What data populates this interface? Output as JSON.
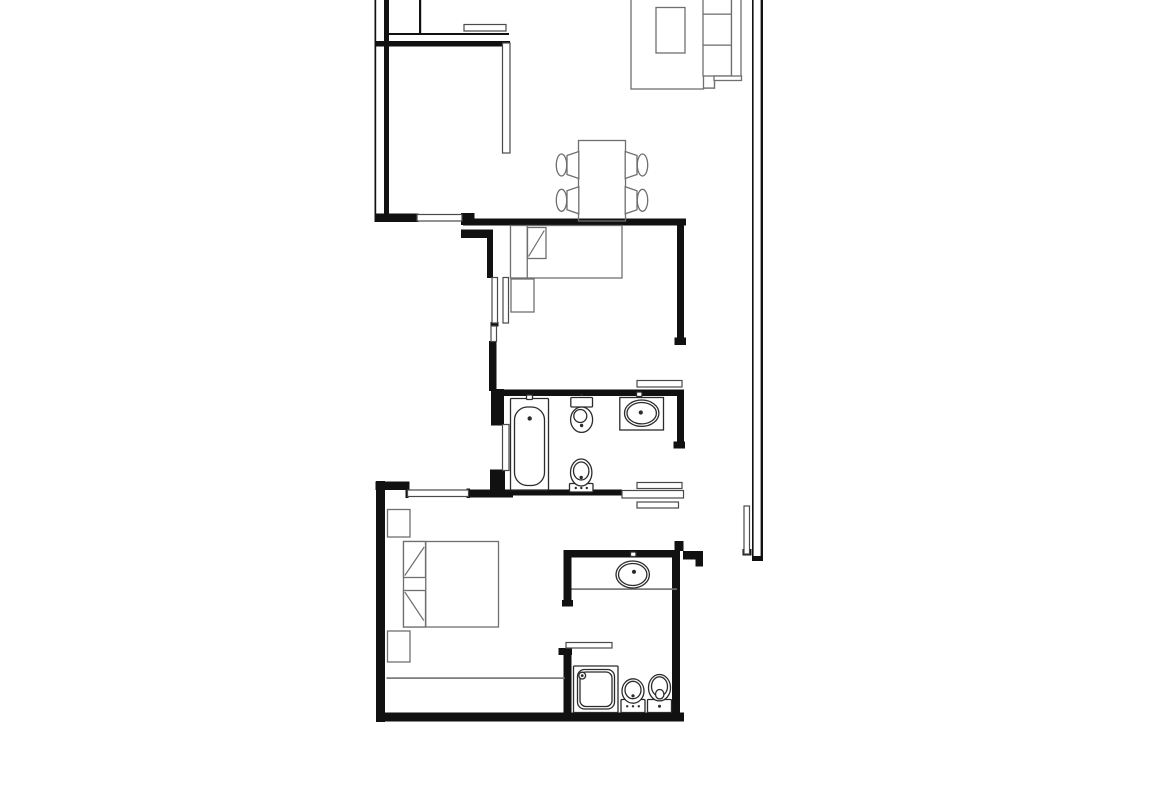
{
  "meta": {
    "title": "apartment-floor-plan",
    "canvas_w": 1170,
    "canvas_h": 785,
    "background": "#ffffff"
  },
  "colors": {
    "wall": "#111111",
    "window": "#4a4a4a",
    "sanitary": "#2b2b2b",
    "furniture": "#6f6f6f",
    "light": "#9a9a9a"
  },
  "walls": [
    {
      "id": "left-wall-outer-line",
      "x": 374.5,
      "y": 0,
      "w": 1.7,
      "h": 221
    },
    {
      "id": "left-wall-inner",
      "x": 384,
      "y": 0,
      "w": 5,
      "h": 216
    },
    {
      "id": "kitchen-wall-thin-line",
      "x": 385,
      "y": 33,
      "w": 124,
      "h": 2
    },
    {
      "id": "kitchen-south-wall",
      "x": 374.5,
      "y": 41,
      "w": 135.5,
      "h": 5.5
    },
    {
      "id": "kitchen-divider-line",
      "x": 419,
      "y": 0,
      "w": 2.2,
      "h": 34
    },
    {
      "id": "living-south-wall",
      "x": 374.5,
      "y": 213.5,
      "w": 44,
      "h": 8.5
    },
    {
      "id": "living-south-jog",
      "x": 461,
      "y": 213,
      "w": 13.5,
      "h": 12
    },
    {
      "id": "bedroom1-north-wall",
      "x": 463,
      "y": 218.5,
      "w": 223,
      "h": 7
    },
    {
      "id": "bedroom1-east-wall",
      "x": 677,
      "y": 219,
      "w": 7,
      "h": 119
    },
    {
      "id": "bedroom1-east-wall-cap",
      "x": 674.5,
      "y": 337.5,
      "w": 11.5,
      "h": 7.5
    },
    {
      "id": "lightwell-stub",
      "x": 461,
      "y": 229.5,
      "w": 32,
      "h": 8.5
    },
    {
      "id": "lightwell-wall-upper",
      "x": 487,
      "y": 238,
      "w": 6,
      "h": 40
    },
    {
      "id": "lightwell-window-connector",
      "x": 490.5,
      "y": 322,
      "w": 8,
      "h": 4.5
    },
    {
      "id": "lightwell-wall-lower",
      "x": 489,
      "y": 341,
      "w": 7.5,
      "h": 50
    },
    {
      "id": "bath1-nw-chunk",
      "x": 491,
      "y": 389,
      "w": 13,
      "h": 36.5
    },
    {
      "id": "bath1-north-wall",
      "x": 491,
      "y": 389.5,
      "w": 193,
      "h": 6.5
    },
    {
      "id": "bath1-east-wall",
      "x": 677,
      "y": 390,
      "w": 7,
      "h": 53
    },
    {
      "id": "bath1-east-wall-cap",
      "x": 673.5,
      "y": 441.5,
      "w": 11.5,
      "h": 7
    },
    {
      "id": "bath1-sw-chunk",
      "x": 490,
      "y": 469.5,
      "w": 15,
      "h": 21
    },
    {
      "id": "bath1-south-wall",
      "x": 508,
      "y": 489.5,
      "w": 114,
      "h": 6
    },
    {
      "id": "bedroom2-west-wall",
      "x": 376,
      "y": 481,
      "w": 9,
      "h": 241
    },
    {
      "id": "bedroom2-north-wall-a",
      "x": 375.5,
      "y": 481.5,
      "w": 34,
      "h": 8.5
    },
    {
      "id": "bedroom2-north-wall-b",
      "x": 467.5,
      "y": 489.5,
      "w": 45.5,
      "h": 8
    },
    {
      "id": "window-bedroom2-cap-left",
      "x": 405.5,
      "y": 488.5,
      "w": 3,
      "h": 9.5
    },
    {
      "id": "window-bedroom2-cap-right",
      "x": 466.5,
      "y": 488.5,
      "w": 3.5,
      "h": 9.5
    },
    {
      "id": "south-wall",
      "x": 376,
      "y": 712.5,
      "w": 308,
      "h": 9
    },
    {
      "id": "bath2-west-wall-upper",
      "x": 563.5,
      "y": 550,
      "w": 8,
      "h": 53
    },
    {
      "id": "bath2-west-cap-1",
      "x": 562,
      "y": 600,
      "w": 11,
      "h": 6.5
    },
    {
      "id": "bath2-west-cap-2",
      "x": 558.5,
      "y": 648,
      "w": 13.5,
      "h": 7
    },
    {
      "id": "bath2-west-wall-lower",
      "x": 563.5,
      "y": 650,
      "w": 8,
      "h": 71
    },
    {
      "id": "bath2-north-wall",
      "x": 563.5,
      "y": 550,
      "w": 112.5,
      "h": 7.5
    },
    {
      "id": "bath2-north-tab",
      "x": 674.5,
      "y": 541,
      "w": 9,
      "h": 10
    },
    {
      "id": "entry-wall",
      "x": 683,
      "y": 551,
      "w": 19.5,
      "h": 8.5
    },
    {
      "id": "entry-wall-cap",
      "x": 695.5,
      "y": 551,
      "w": 7.5,
      "h": 15.5
    },
    {
      "id": "bath2-east-wall",
      "x": 672,
      "y": 550,
      "w": 8,
      "h": 171
    },
    {
      "id": "right-wall-inner-line",
      "x": 752,
      "y": 0,
      "w": 1.6,
      "h": 557
    },
    {
      "id": "right-wall-outer-line",
      "x": 760.6,
      "y": 0,
      "w": 2.4,
      "h": 561
    },
    {
      "id": "right-wall-cap",
      "x": 752,
      "y": 556,
      "w": 11,
      "h": 5
    },
    {
      "id": "entry-leaf-cap",
      "x": 742.5,
      "y": 549,
      "w": 9,
      "h": 6.5
    }
  ],
  "openings": [
    {
      "id": "window-living",
      "x": 417,
      "y": 214.5,
      "w": 45,
      "h": 6.5
    },
    {
      "id": "window-lightwell-a",
      "x": 492,
      "y": 277.5,
      "w": 5.5,
      "h": 45.5
    },
    {
      "id": "window-lightwell-b",
      "x": 503,
      "y": 277.5,
      "w": 5.5,
      "h": 45.5
    },
    {
      "id": "window-lightwell-c",
      "x": 491,
      "y": 326,
      "w": 5.5,
      "h": 15.5
    },
    {
      "id": "window-bath1",
      "x": 502.5,
      "y": 424.5,
      "w": 6.5,
      "h": 46
    },
    {
      "id": "window-bedroom2",
      "x": 407.5,
      "y": 490,
      "w": 61,
      "h": 6.5
    },
    {
      "id": "door-leaf-bath1-top",
      "x": 637,
      "y": 380.5,
      "w": 45,
      "h": 6.5
    },
    {
      "id": "door-leaf-corridor-a",
      "x": 637,
      "y": 482.5,
      "w": 45,
      "h": 6
    },
    {
      "id": "passage-wall-bar",
      "x": 622,
      "y": 490.5,
      "w": 61.5,
      "h": 7.5
    },
    {
      "id": "door-leaf-corridor-b",
      "x": 637,
      "y": 502,
      "w": 41.5,
      "h": 6
    },
    {
      "id": "entry-door-leaf",
      "x": 744,
      "y": 506,
      "w": 5.5,
      "h": 48
    },
    {
      "id": "door-leaf-bath2",
      "x": 566,
      "y": 642.5,
      "w": 46,
      "h": 5.5
    },
    {
      "id": "kitchen-counter",
      "x": 464,
      "y": 24.5,
      "w": 42,
      "h": 6.5
    },
    {
      "id": "kitchen-partition",
      "x": 502.5,
      "y": 43,
      "w": 7.5,
      "h": 110
    }
  ],
  "furniture_rects": [
    {
      "id": "sofa-body",
      "x": 631,
      "y": -5,
      "w": 72.5,
      "h": 94
    },
    {
      "id": "sofa-coffee-table",
      "x": 656,
      "y": 7.5,
      "w": 29,
      "h": 45.5
    },
    {
      "id": "sofa-seat-column",
      "x": 703,
      "y": -5,
      "w": 28.5,
      "h": 81
    },
    {
      "id": "sofa-backrest",
      "x": 731.5,
      "y": -5,
      "w": 9.5,
      "h": 85
    },
    {
      "id": "sofa-armrest",
      "x": 714,
      "y": 76,
      "w": 27.5,
      "h": 4.5
    },
    {
      "id": "dining-table",
      "x": 578.5,
      "y": 140.5,
      "w": 47,
      "h": 80.5,
      "fill": "none"
    },
    {
      "id": "bed-single",
      "x": 510.5,
      "y": 225.5,
      "w": 111.5,
      "h": 52.5
    },
    {
      "id": "bed-single-pillow",
      "x": 527.5,
      "y": 227.5,
      "w": 18.5,
      "h": 31
    },
    {
      "id": "nightstand-bedroom1",
      "x": 511,
      "y": 279,
      "w": 23,
      "h": 33
    },
    {
      "id": "bed-double",
      "x": 403.5,
      "y": 541.5,
      "w": 95,
      "h": 85.5
    },
    {
      "id": "bed-double-pillow-top",
      "x": 403.5,
      "y": 541.5,
      "w": 22,
      "h": 36
    },
    {
      "id": "bed-double-pillow-bottom",
      "x": 403.5,
      "y": 590.5,
      "w": 22,
      "h": 36.5
    },
    {
      "id": "nightstand-bedroom2-top",
      "x": 387.5,
      "y": 509.5,
      "w": 22.5,
      "h": 27.5
    },
    {
      "id": "nightstand-bedroom2-bottom",
      "x": 387.5,
      "y": 631,
      "w": 22.5,
      "h": 31
    }
  ],
  "furniture_lines": [
    {
      "id": "sofa-cushion-divider-1",
      "x": 703,
      "y": 13.5,
      "w": 28.5,
      "h": 1.3
    },
    {
      "id": "sofa-cushion-divider-2",
      "x": 703,
      "y": 44.5,
      "w": 28.5,
      "h": 1.3
    },
    {
      "id": "sofa-step-h",
      "x": 703,
      "y": 87.4,
      "w": 11.8,
      "h": 1.4
    },
    {
      "id": "sofa-step-v",
      "x": 713.8,
      "y": 80,
      "w": 1.4,
      "h": 8.8
    },
    {
      "id": "bed-single-headboard-line",
      "x": 526.6,
      "y": 225.5,
      "w": 1.3,
      "h": 52.5
    },
    {
      "id": "bed-double-headboard-line",
      "x": 425.1,
      "y": 541.5,
      "w": 1.3,
      "h": 85.5
    },
    {
      "id": "wardrobe-line",
      "x": 386.5,
      "y": 677.3,
      "w": 178.5,
      "h": 1.6
    },
    {
      "id": "vanity2-front-edge",
      "x": 571.5,
      "y": 588.3,
      "w": 105.5,
      "h": 1.6
    }
  ],
  "sanitary_rects": [
    {
      "id": "bathtub-outer",
      "x": 510.5,
      "y": 398.5,
      "w": 38,
      "h": 91.5,
      "r": 1
    },
    {
      "id": "bathtub-inner",
      "x": 514.5,
      "y": 407,
      "w": 30,
      "h": 78.5,
      "r": 13
    },
    {
      "id": "bathtub-tap",
      "x": 526.5,
      "y": 395,
      "w": 6,
      "h": 4.5,
      "r": 1
    },
    {
      "id": "toilet1-cistern",
      "x": 570.8,
      "y": 397.5,
      "w": 21.7,
      "h": 9.5,
      "r": 1
    },
    {
      "id": "vanity1-counter",
      "x": 619.8,
      "y": 397.5,
      "w": 43.7,
      "h": 32.5,
      "r": 0
    },
    {
      "id": "sink1-tap",
      "x": 636.5,
      "y": 392,
      "w": 5.5,
      "h": 4.5,
      "r": 1
    },
    {
      "id": "bidet1-base",
      "x": 569.5,
      "y": 483.5,
      "w": 23.5,
      "h": 8.5,
      "r": 1
    },
    {
      "id": "sink2-tap",
      "x": 630.5,
      "y": 552,
      "w": 5.5,
      "h": 4.5,
      "r": 1
    },
    {
      "id": "shower-tray-outer",
      "x": 573.5,
      "y": 666,
      "w": 44.5,
      "h": 46.5,
      "r": 1
    },
    {
      "id": "shower-tray-mid",
      "x": 577.5,
      "y": 669.5,
      "w": 37,
      "h": 39.5,
      "r": 7
    },
    {
      "id": "shower-tray-inner",
      "x": 580,
      "y": 672,
      "w": 32,
      "h": 34.5,
      "r": 6
    },
    {
      "id": "toilet2-base",
      "x": 621,
      "y": 699.5,
      "w": 24,
      "h": 13,
      "r": 1
    },
    {
      "id": "bidet2-base",
      "x": 647.5,
      "y": 699.5,
      "w": 24,
      "h": 13,
      "r": 1
    }
  ],
  "sanitary_ellipses": [
    {
      "id": "toilet1-bowl",
      "cx": 581.6,
      "cy": 419.7,
      "rx": 11,
      "ry": 12.7
    },
    {
      "id": "toilet1-flush",
      "cx": 580.3,
      "cy": 416,
      "rx": 6.5,
      "ry": 6.5
    },
    {
      "id": "sink1-basin-outer",
      "cx": 641.7,
      "cy": 413.2,
      "rx": 17.2,
      "ry": 13.2
    },
    {
      "id": "sink1-basin-inner",
      "cx": 641.7,
      "cy": 413.2,
      "rx": 14.7,
      "ry": 10.7
    },
    {
      "id": "bidet1-bowl",
      "cx": 581.2,
      "cy": 472.5,
      "rx": 10.7,
      "ry": 13.5
    },
    {
      "id": "bidet1-inner",
      "cx": 581.2,
      "cy": 471,
      "rx": 7.7,
      "ry": 9
    },
    {
      "id": "sink2-basin-outer",
      "cx": 632.7,
      "cy": 574.5,
      "rx": 16.7,
      "ry": 13.5
    },
    {
      "id": "sink2-basin-inner",
      "cx": 632.7,
      "cy": 574.5,
      "rx": 14.2,
      "ry": 11
    },
    {
      "id": "shower-head-ring",
      "cx": 582.2,
      "cy": 675.6,
      "rx": 3.4,
      "ry": 3.4
    },
    {
      "id": "toilet2-bowl",
      "cx": 633,
      "cy": 691,
      "rx": 11,
      "ry": 12.2
    },
    {
      "id": "toilet2-inner",
      "cx": 633,
      "cy": 690,
      "rx": 8,
      "ry": 8.7
    },
    {
      "id": "bidet2-bowl",
      "cx": 659.5,
      "cy": 687.7,
      "rx": 11,
      "ry": 13.2
    },
    {
      "id": "bidet2-inner",
      "cx": 659.5,
      "cy": 686.5,
      "rx": 8,
      "ry": 9.7
    },
    {
      "id": "bidet2-drain",
      "cx": 659.7,
      "cy": 694.2,
      "rx": 4.2,
      "ry": 4.7
    },
    {
      "id": "chair-back-top-left",
      "cx": 561.5,
      "cy": 165,
      "rx": 5.2,
      "ry": 11,
      "stroke": "furniture"
    },
    {
      "id": "chair-back-bottom-left",
      "cx": 561.5,
      "cy": 200.3,
      "rx": 5.2,
      "ry": 11,
      "stroke": "furniture"
    },
    {
      "id": "chair-back-top-right",
      "cx": 642.5,
      "cy": 165,
      "rx": 5.2,
      "ry": 11,
      "stroke": "furniture"
    },
    {
      "id": "chair-back-bottom-right",
      "cx": 642.5,
      "cy": 200.3,
      "rx": 5.2,
      "ry": 11,
      "stroke": "furniture"
    }
  ],
  "polygons": [
    {
      "id": "chair-seat-top-left",
      "points": [
        [
          567,
          155.5
        ],
        [
          578.8,
          151.5
        ],
        [
          578.8,
          178.5
        ],
        [
          567,
          174.5
        ]
      ]
    },
    {
      "id": "chair-seat-bottom-left",
      "points": [
        [
          567,
          190.8
        ],
        [
          578.8,
          186.8
        ],
        [
          578.8,
          213.8
        ],
        [
          567,
          209.8
        ]
      ]
    },
    {
      "id": "chair-seat-top-right",
      "points": [
        [
          625.2,
          151.5
        ],
        [
          637,
          155.5
        ],
        [
          637,
          174.5
        ],
        [
          625.2,
          178.5
        ]
      ]
    },
    {
      "id": "chair-seat-bottom-right",
      "points": [
        [
          625.2,
          186.8
        ],
        [
          637,
          190.8
        ],
        [
          637,
          209.8
        ],
        [
          625.2,
          213.8
        ]
      ]
    }
  ],
  "diagonals": [
    {
      "id": "bed-single-pillow-fold",
      "x1": 544.3,
      "y1": 230.5,
      "x2": 528.5,
      "y2": 256.5
    },
    {
      "id": "bed-double-pillow-fold-top",
      "x1": 404.8,
      "y1": 575.5,
      "x2": 424.2,
      "y2": 547
    },
    {
      "id": "bed-double-pillow-fold-bottom",
      "x1": 404.8,
      "y1": 592,
      "x2": 423.8,
      "y2": 620.5
    }
  ],
  "dots": [
    {
      "id": "bathtub-faucet-dot",
      "cx": 529.7,
      "cy": 418.5,
      "r": 2.2
    },
    {
      "id": "toilet1-dot",
      "cx": 581.6,
      "cy": 425.5,
      "r": 1.7
    },
    {
      "id": "toilet1-cistern-dot",
      "cx": 581.6,
      "cy": 395,
      "r": 1.1
    },
    {
      "id": "sink1-faucet-dot",
      "cx": 640.8,
      "cy": 412.5,
      "r": 2.1
    },
    {
      "id": "bidet1-dot",
      "cx": 581.2,
      "cy": 477.5,
      "r": 1.7
    },
    {
      "id": "bidet1-base-dot-1",
      "cx": 575.8,
      "cy": 488,
      "r": 1.2
    },
    {
      "id": "bidet1-base-dot-2",
      "cx": 581.3,
      "cy": 488,
      "r": 1.2
    },
    {
      "id": "bidet1-base-dot-3",
      "cx": 586.8,
      "cy": 488,
      "r": 1.2
    },
    {
      "id": "sink2-faucet-dot",
      "cx": 634,
      "cy": 571.8,
      "r": 2.1
    },
    {
      "id": "shower-head-dot",
      "cx": 582.2,
      "cy": 675.6,
      "r": 1.4
    },
    {
      "id": "toilet2-dot",
      "cx": 633,
      "cy": 695.8,
      "r": 1.6
    },
    {
      "id": "toilet2-base-dot-1",
      "cx": 627.2,
      "cy": 706.3,
      "r": 1.2
    },
    {
      "id": "toilet2-base-dot-2",
      "cx": 633,
      "cy": 706.3,
      "r": 1.2
    },
    {
      "id": "toilet2-base-dot-3",
      "cx": 638.8,
      "cy": 706.3,
      "r": 1.2
    },
    {
      "id": "bidet2-base-dot",
      "cx": 659.5,
      "cy": 706.3,
      "r": 1.5
    }
  ]
}
